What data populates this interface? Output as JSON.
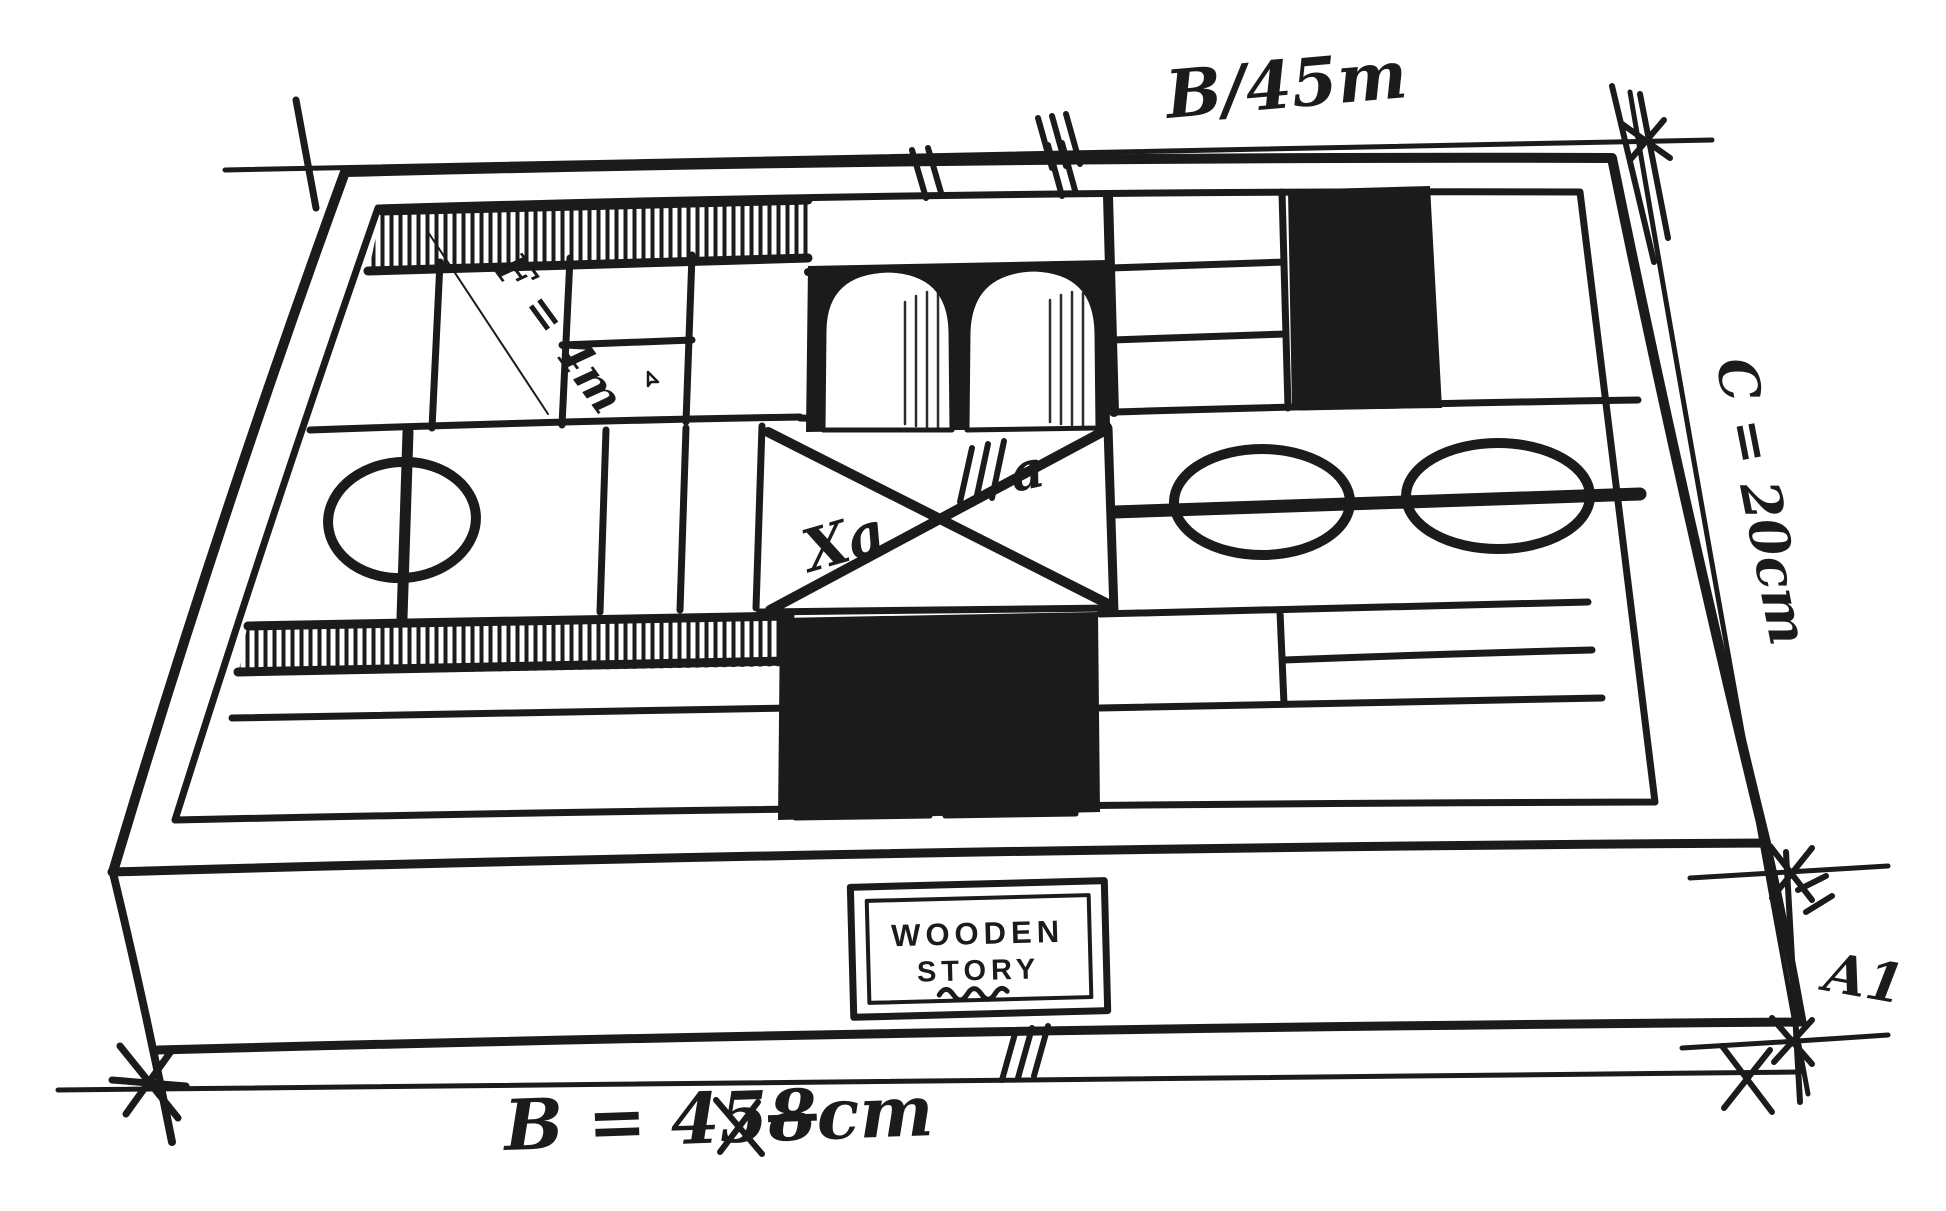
{
  "annotations": {
    "top_width_label": "B/45m",
    "depth_label": "C = 20cm",
    "height_label": "A1",
    "bottom_width_prefix": "B = 45",
    "bottom_width_struck": "8",
    "bottom_width_suffix": "cm",
    "block_dim_label": "F = 4m",
    "center_left_label": "Xa",
    "center_right_label": "a"
  },
  "brand_label": {
    "line1": "WOODEN",
    "line2": "STORY"
  },
  "colors": {
    "ink": "#1b1b1b",
    "paper": "#ffffff"
  }
}
